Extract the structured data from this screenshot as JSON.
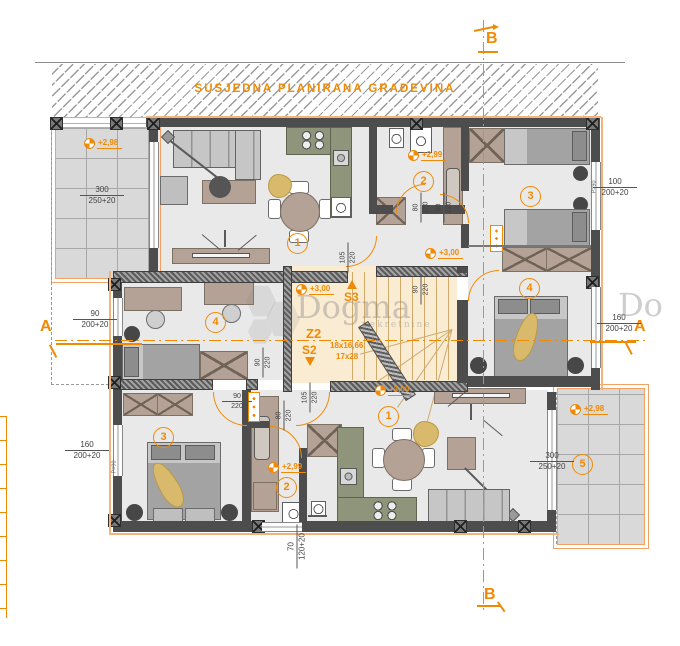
{
  "colors": {
    "accent": "#f08a05",
    "wall": "#4d4d4d",
    "stair_fill": "#faecd3",
    "kitchen": "#8f957b",
    "floor": "#e9e9e9",
    "terrace": "#d9d9d9",
    "gold": "#d9ba6c",
    "furniture_tan": "#b4a296"
  },
  "neighbor": {
    "label": "SUSJEDNA PLANIRANA GRAĐEVINA"
  },
  "sections": {
    "b_top": "B",
    "b_bottom": "B",
    "a_left": "A",
    "a_right": "A"
  },
  "stair_core": {
    "up_label": "S3",
    "zone_label": "Z2",
    "down_label": "S2",
    "flight_label": "18x16,66",
    "riser_label": "17x28"
  },
  "level_markers": [
    {
      "label": "+2,98"
    },
    {
      "label": "+2,99"
    },
    {
      "label": "+3,00"
    },
    {
      "label": "+3,00"
    },
    {
      "label": "+3,00"
    },
    {
      "label": "+2,99"
    },
    {
      "label": "+2,98"
    }
  ],
  "room_numbers": [
    {
      "number": "1"
    },
    {
      "number": "2"
    },
    {
      "number": "3"
    },
    {
      "number": "4"
    },
    {
      "number": "4"
    },
    {
      "number": "1"
    },
    {
      "number": "2"
    },
    {
      "number": "3"
    },
    {
      "number": "5"
    }
  ],
  "window_dimensions": [
    {
      "top": "300",
      "bottom": "250+20"
    },
    {
      "top": "100",
      "bottom": "200+20"
    },
    {
      "top": "90",
      "bottom": "200+20"
    },
    {
      "top": "160",
      "bottom": "200+20"
    },
    {
      "top": "160",
      "bottom": "200+20"
    },
    {
      "top": "300",
      "bottom": "250+20"
    },
    {
      "top": "70",
      "bottom": "120+20"
    }
  ],
  "door_dimensions": [
    {
      "top": "80",
      "bottom": "220"
    },
    {
      "top": "90",
      "bottom": "220"
    },
    {
      "top": "105",
      "bottom": "220"
    },
    {
      "top": "90",
      "bottom": "220"
    },
    {
      "top": "90",
      "bottom": "220"
    },
    {
      "top": "90",
      "bottom": "220"
    },
    {
      "top": "105",
      "bottom": "220"
    },
    {
      "top": "80",
      "bottom": "220"
    }
  ],
  "parapet_labels": [
    {
      "label": "P=90"
    },
    {
      "label": "P=90"
    }
  ],
  "watermark": {
    "name": "Dogma",
    "subtitle": "nekretnine",
    "partial": "Do"
  }
}
